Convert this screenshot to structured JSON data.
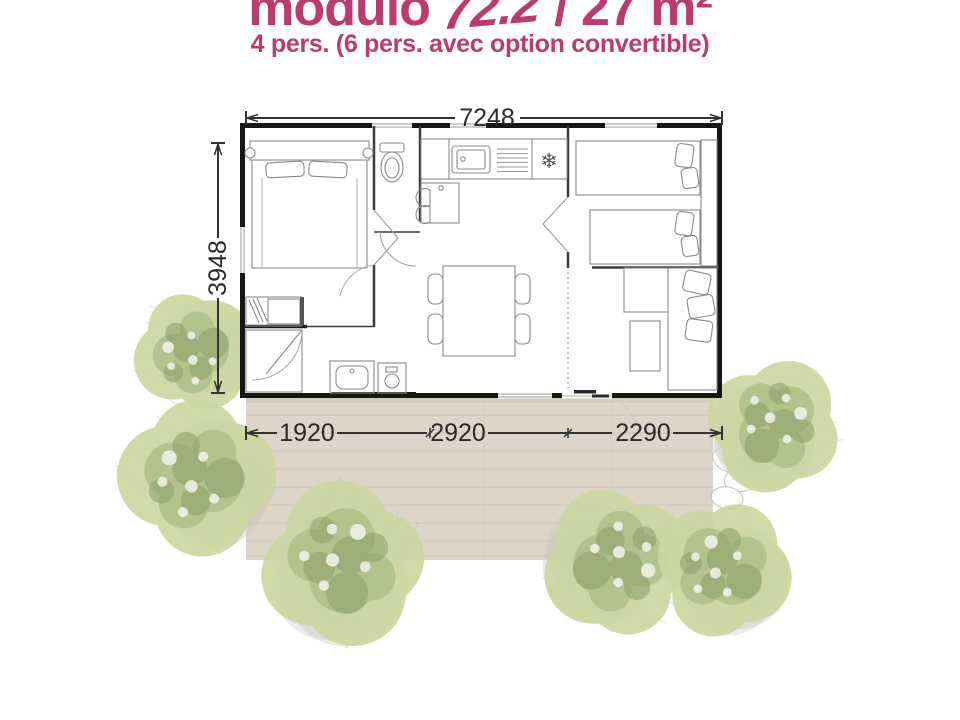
{
  "header": {
    "title_prefix": "modulo",
    "title_model": "72.2",
    "title_suffix": "/ 27 m²",
    "subtitle": "4 pers. (6 pers. avec option convertible)",
    "accent_color": "#bd3a6f"
  },
  "dimensions": {
    "total_width": "7248",
    "total_depth": "3948",
    "segments": [
      "1920",
      "2920",
      "2290"
    ]
  },
  "icons": {
    "fridge": "❄",
    "tree": "tree-icon"
  },
  "colors": {
    "accent": "#bd3a6f",
    "deck": "#ded4c7",
    "deck_line": "#cdc0b0",
    "tree_base": "#cbd7a0",
    "tree_mid": "#a9bb82",
    "tree_dark": "#8ba066",
    "tree_shadow": "#c7c6c1",
    "wall": "#161616",
    "dimension": "#2b2a28"
  }
}
